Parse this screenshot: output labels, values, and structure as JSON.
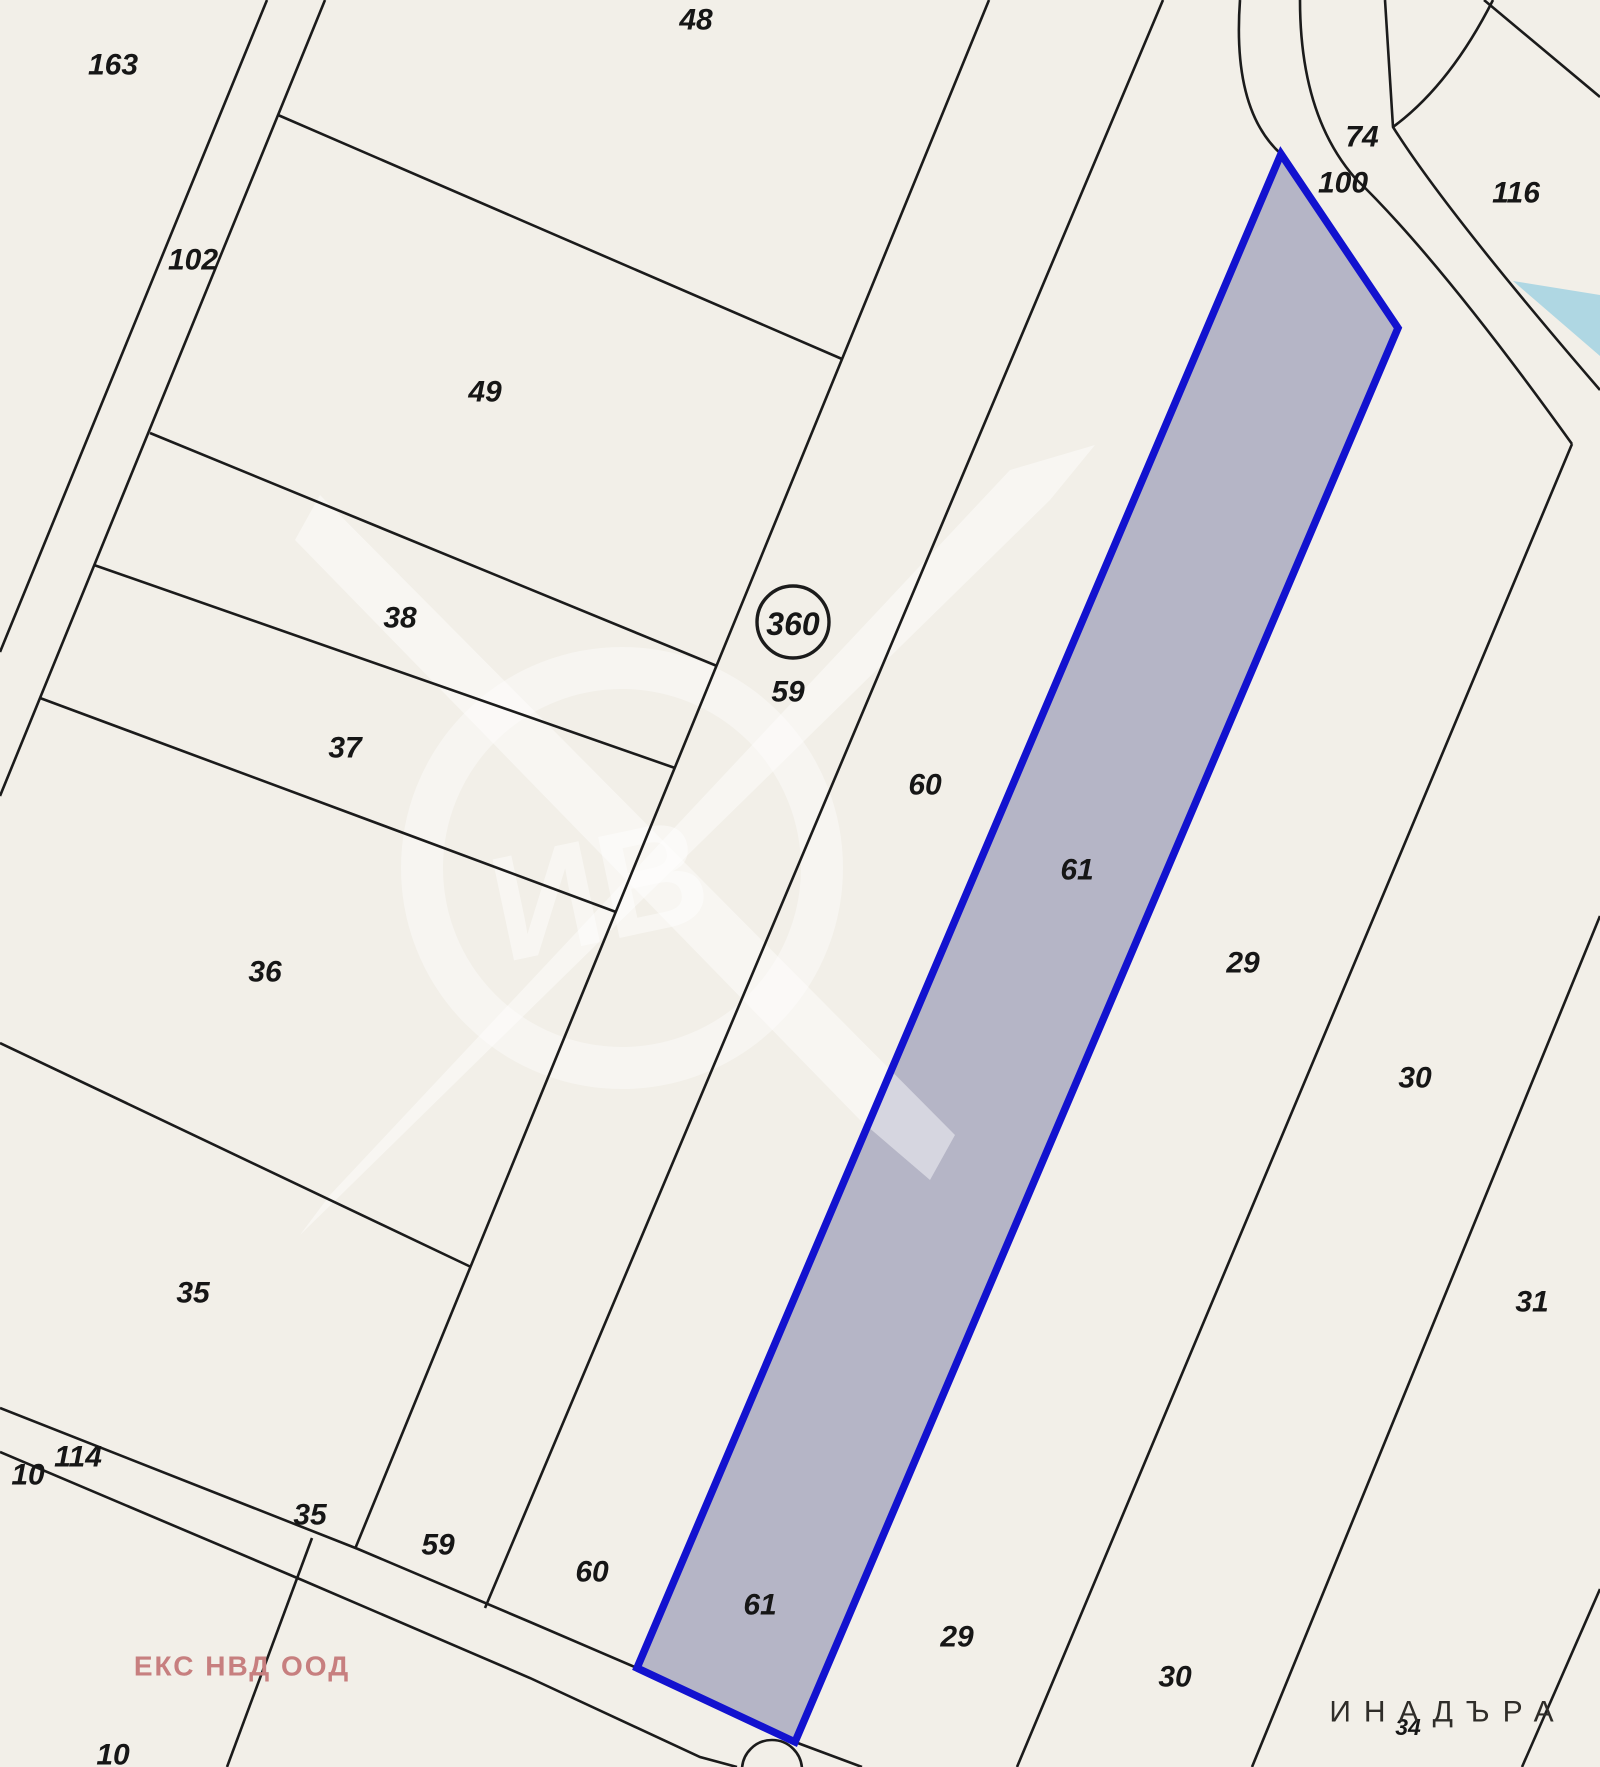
{
  "colors": {
    "background": "#f2efe8",
    "line": "#1b1b1b",
    "label": "#161616",
    "highlight_fill": "#b5b5c6",
    "highlight_stroke": "#1212cf",
    "water": "#afd7e3",
    "company": "#c77f7f",
    "region": "#2f2d29"
  },
  "map": {
    "junction_badge": "360",
    "region_label": "ИНАДЪРА",
    "company_watermark": "ЕКС НВД ООД",
    "watermark_monogram": "ИВ",
    "highlighted_parcel_number": "61",
    "labels": [
      {
        "text": "163",
        "x": 113,
        "y": 65
      },
      {
        "text": "48",
        "x": 696,
        "y": 20
      },
      {
        "text": "102",
        "x": 193,
        "y": 260
      },
      {
        "text": "49",
        "x": 485,
        "y": 392
      },
      {
        "text": "38",
        "x": 400,
        "y": 618
      },
      {
        "text": "37",
        "x": 345,
        "y": 748
      },
      {
        "text": "36",
        "x": 265,
        "y": 972
      },
      {
        "text": "35",
        "x": 193,
        "y": 1293
      },
      {
        "text": "59",
        "x": 788,
        "y": 692
      },
      {
        "text": "60",
        "x": 925,
        "y": 785
      },
      {
        "text": "61",
        "x": 1077,
        "y": 870
      },
      {
        "text": "29",
        "x": 1243,
        "y": 963
      },
      {
        "text": "30",
        "x": 1415,
        "y": 1078
      },
      {
        "text": "31",
        "x": 1532,
        "y": 1302
      },
      {
        "text": "74",
        "x": 1362,
        "y": 137
      },
      {
        "text": "100",
        "x": 1343,
        "y": 183
      },
      {
        "text": "116",
        "x": 1516,
        "y": 193
      },
      {
        "text": "114",
        "x": 78,
        "y": 1457
      },
      {
        "text": "10",
        "x": 28,
        "y": 1475
      },
      {
        "text": "35",
        "x": 310,
        "y": 1515
      },
      {
        "text": "59",
        "x": 438,
        "y": 1545
      },
      {
        "text": "60",
        "x": 592,
        "y": 1572
      },
      {
        "text": "61",
        "x": 760,
        "y": 1605
      },
      {
        "text": "29",
        "x": 957,
        "y": 1637
      },
      {
        "text": "30",
        "x": 1175,
        "y": 1677
      },
      {
        "text": "10",
        "x": 113,
        "y": 1755
      },
      {
        "text": "34",
        "x": 1408,
        "y": 1727,
        "small": true
      }
    ]
  }
}
